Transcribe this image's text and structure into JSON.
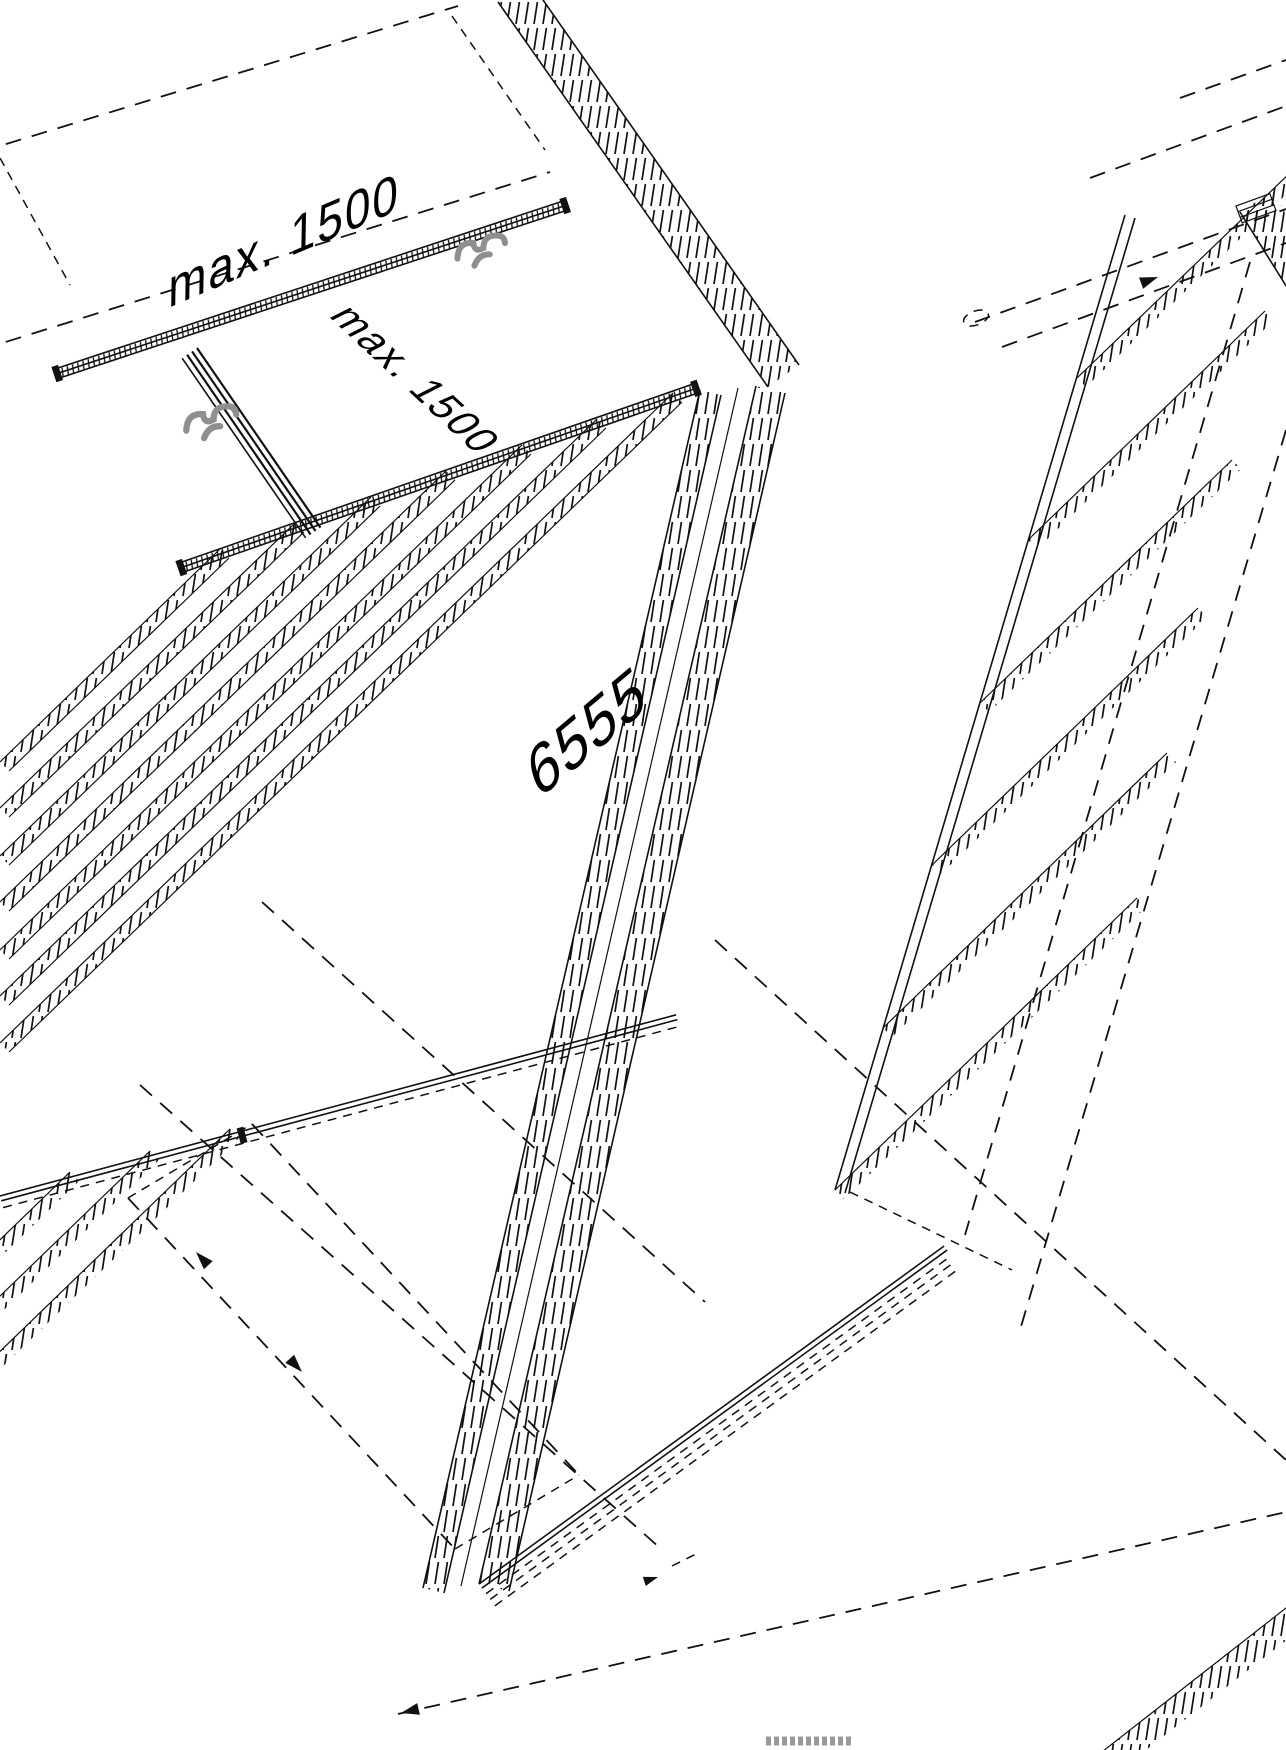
{
  "diagram": {
    "type": "isometric-mounting-assembly-drawing",
    "background": "#ffffff",
    "line_color": "#111111",
    "clamp_color": "#8f8f8f",
    "labels": {
      "dim_top": "max. 1500",
      "dim_inner": "max. 1500",
      "length": "6555"
    },
    "icons": {
      "clamp": "clamp-icon",
      "arrowhead": "arrowhead-icon"
    }
  }
}
